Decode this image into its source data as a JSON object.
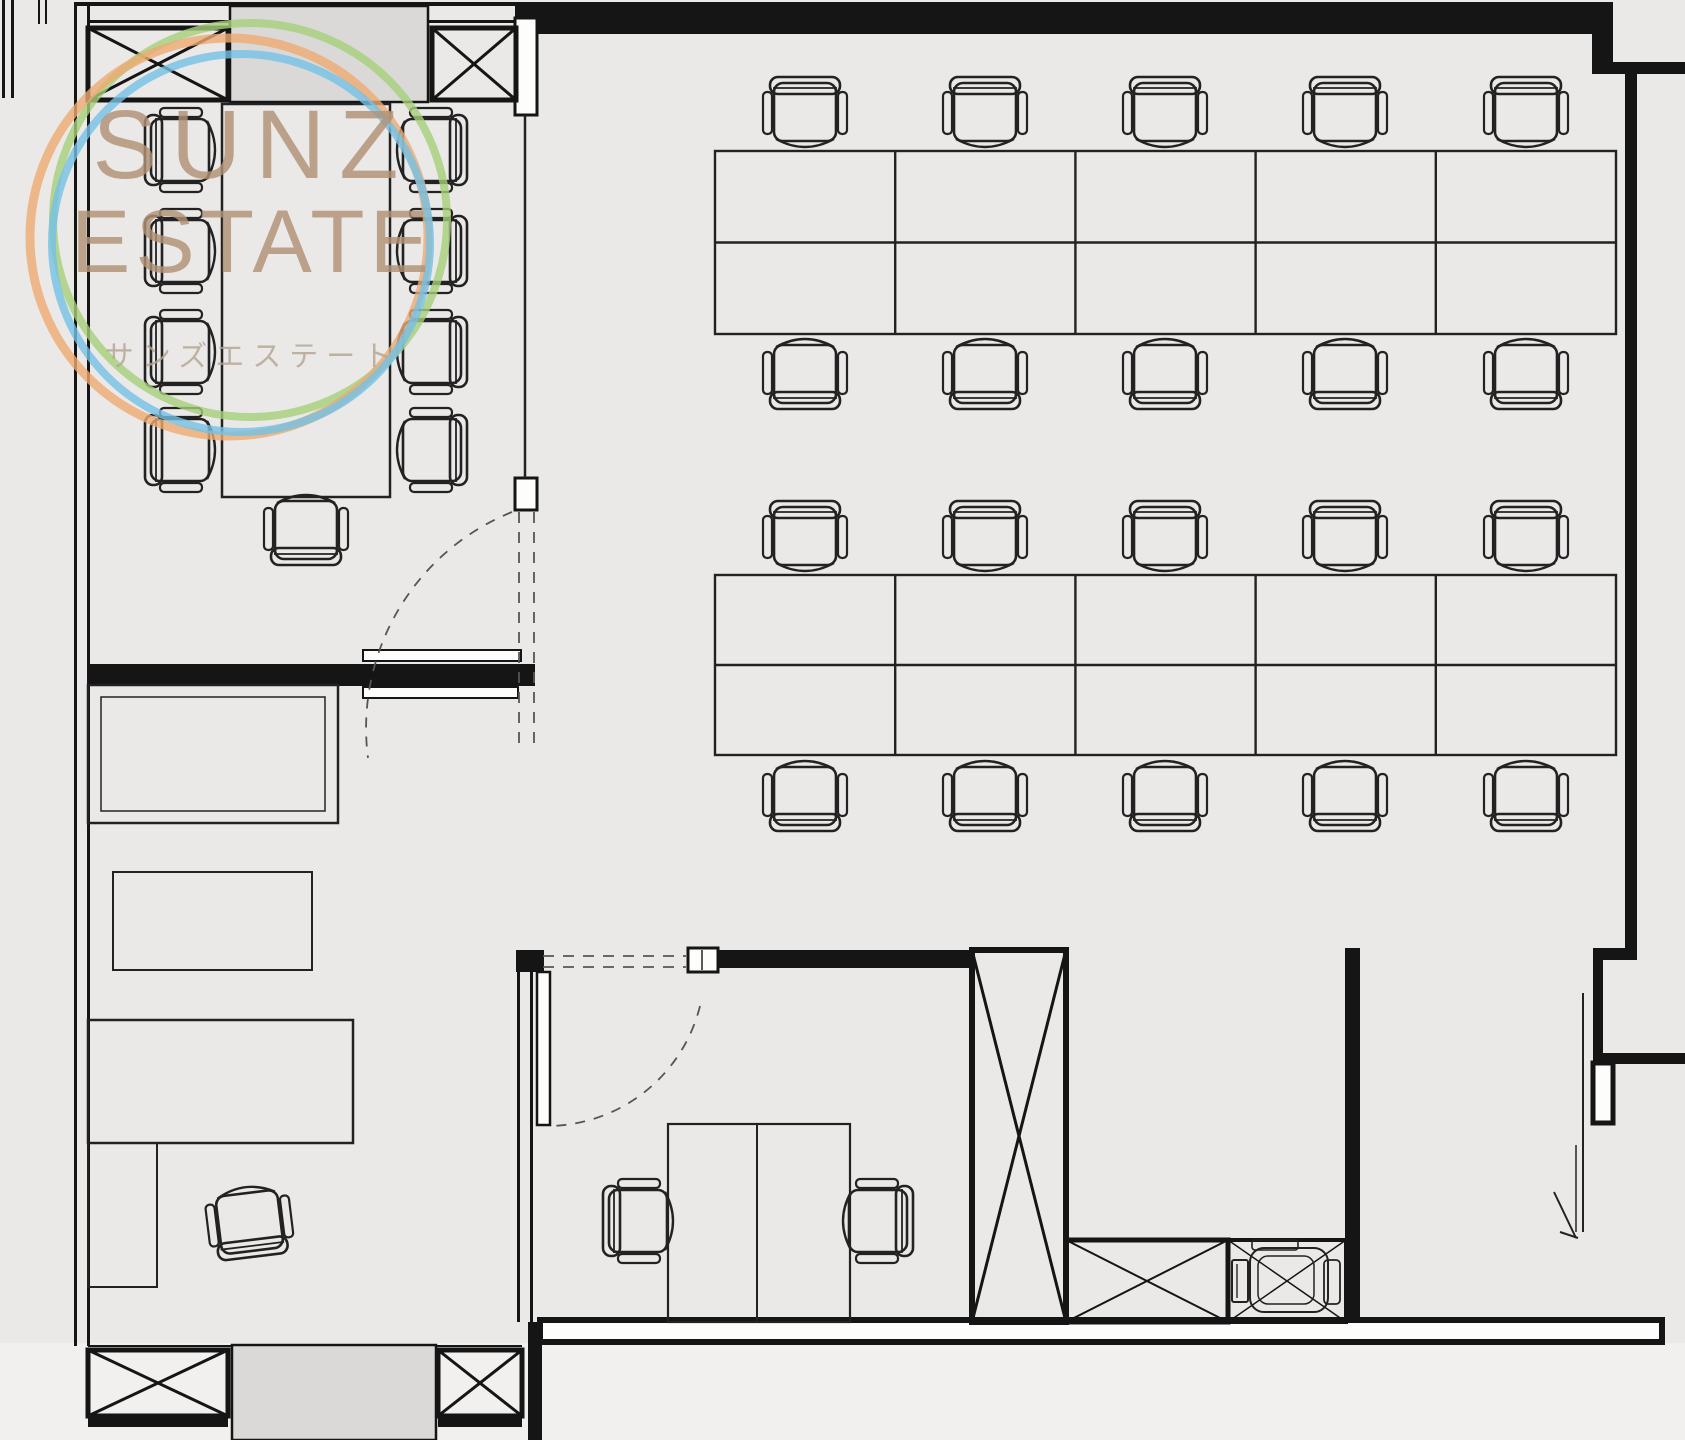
{
  "watermark": {
    "line1": "SUNZ",
    "line2": "ESTATE",
    "line3": "サンズエステート",
    "ring_green": "#a5cf7a",
    "ring_orange": "#edaa72",
    "ring_blue": "#74c0e6",
    "text_color": "#b29276"
  },
  "palette": {
    "floor": "#eae9e7",
    "outside": "#f1f0ee",
    "wall": "#151515",
    "furniture_line": "#222222",
    "panel_gray": "#dad9d7",
    "dash": "#555555"
  },
  "plan": {
    "fills": [
      {
        "r": [
          0,
          1343,
          1685,
          97
        ],
        "color": "#f1f0ee"
      }
    ],
    "walls": [
      [
        75,
        2,
        1518,
        4
      ],
      [
        74,
        2,
        3,
        1344
      ],
      [
        87,
        2,
        3,
        1344
      ],
      [
        88,
        20,
        430,
        3
      ],
      [
        515,
        6,
        1078,
        28
      ],
      [
        1592,
        2,
        21,
        72
      ],
      [
        1613,
        62,
        72,
        12
      ],
      [
        1625,
        72,
        12,
        878
      ],
      [
        1593,
        948,
        44,
        12
      ],
      [
        1593,
        958,
        10,
        98
      ],
      [
        1593,
        1053,
        92,
        11
      ],
      [
        88,
        664,
        447,
        22
      ],
      [
        515,
        103,
        22,
        12
      ],
      [
        516,
        950,
        28,
        22
      ],
      [
        716,
        950,
        258,
        18
      ],
      [
        1345,
        948,
        15,
        374
      ],
      [
        528,
        1322,
        14,
        118
      ],
      [
        517,
        952,
        3,
        370
      ],
      [
        530,
        952,
        3,
        370
      ],
      [
        2,
        0,
        3,
        98
      ],
      [
        11,
        0,
        3,
        98
      ],
      [
        38,
        0,
        2,
        24
      ],
      [
        45,
        0,
        2,
        24
      ],
      [
        88,
        1345,
        434,
        2
      ],
      [
        88,
        1416,
        140,
        11
      ],
      [
        438,
        1416,
        84,
        11
      ]
    ],
    "hollow": [
      {
        "r": [
          515,
          18,
          22,
          97
        ],
        "sw": 3
      },
      {
        "r": [
          515,
          478,
          22,
          32
        ],
        "sw": 3
      },
      {
        "r": [
          688,
          948,
          30,
          24
        ],
        "sw": 3
      },
      {
        "r": [
          1593,
          1063,
          20,
          60
        ],
        "sw": 5
      },
      {
        "r": [
          540,
          1320,
          1122,
          22
        ],
        "sw": 6
      },
      {
        "r": [
          537,
          972,
          13,
          153
        ],
        "sw": 2.5
      },
      {
        "r": [
          363,
          650,
          158,
          11
        ],
        "sw": 2
      },
      {
        "r": [
          363,
          687,
          155,
          11
        ],
        "sw": 2
      }
    ],
    "panels": [
      {
        "r": [
          230,
          6,
          198,
          96
        ]
      },
      {
        "r": [
          232,
          1345,
          204,
          95
        ]
      }
    ],
    "xboxes": [
      {
        "r": [
          88,
          28,
          140,
          72
        ],
        "sw": 5,
        "xw": 3
      },
      {
        "r": [
          432,
          28,
          84,
          72
        ],
        "sw": 5,
        "xw": 3
      },
      {
        "r": [
          88,
          1350,
          140,
          66
        ],
        "sw": 5,
        "xw": 3
      },
      {
        "r": [
          438,
          1350,
          84,
          66
        ],
        "sw": 5,
        "xw": 3
      },
      {
        "r": [
          972,
          950,
          94,
          372
        ],
        "sw": 6,
        "xw": 3
      },
      {
        "r": [
          1066,
          1240,
          162,
          82
        ],
        "sw": 5,
        "xw": 2
      },
      {
        "r": [
          1228,
          1240,
          118,
          82
        ],
        "sw": 4,
        "xw": 1.5
      }
    ],
    "furniture": [
      {
        "r": [
          222,
          104,
          168,
          393
        ],
        "sw": 2.5
      },
      {
        "r": [
          88,
          685,
          250,
          138
        ],
        "sw": 2.5
      },
      {
        "r": [
          101,
          697,
          224,
          114
        ],
        "sw": 1.5
      },
      {
        "r": [
          113,
          872,
          199,
          98
        ],
        "sw": 2
      },
      {
        "r": [
          88,
          1020,
          265,
          123
        ],
        "sw": 2.5
      },
      {
        "r": [
          88,
          1143,
          69,
          144
        ],
        "sw": 2
      },
      {
        "r": [
          668,
          1124,
          182,
          198
        ],
        "sw": 2.2
      }
    ],
    "desk_blocks": [
      {
        "r": [
          715,
          151,
          901,
          183
        ],
        "cols": 5,
        "rows": 2,
        "sw": 2.4
      },
      {
        "r": [
          715,
          575,
          901,
          180
        ],
        "cols": 5,
        "rows": 2,
        "sw": 2.4
      }
    ],
    "lines": [
      [
        525,
        115,
        525,
        478,
        2.5
      ],
      [
        702,
        950,
        702,
        970,
        1.5
      ],
      [
        757,
        1124,
        757,
        1322,
        2
      ],
      [
        1583,
        993,
        1583,
        1232,
        2
      ],
      [
        1576,
        1145,
        1576,
        1232,
        1.5
      ],
      [
        1554,
        1192,
        1576,
        1238,
        2
      ],
      [
        1560,
        1232,
        1578,
        1238,
        2
      ]
    ],
    "dashed": [
      [
        519,
        512,
        519,
        748
      ],
      [
        534,
        512,
        534,
        748
      ],
      [
        543,
        956,
        686,
        956
      ],
      [
        543,
        967,
        686,
        967
      ]
    ],
    "arcs": [
      "M 512 512 A 233 233 0 0 0 368 758",
      "M 700 1006 A 158 158 0 0 1 550 1126"
    ],
    "chairs": [
      [
        805,
        116,
        "up",
        0
      ],
      [
        985,
        116,
        "up",
        0
      ],
      [
        1165,
        116,
        "up",
        0
      ],
      [
        1345,
        116,
        "up",
        0
      ],
      [
        1526,
        116,
        "up",
        0
      ],
      [
        805,
        370,
        "down",
        0
      ],
      [
        985,
        370,
        "down",
        0
      ],
      [
        1165,
        370,
        "down",
        0
      ],
      [
        1345,
        370,
        "down",
        0
      ],
      [
        1526,
        370,
        "down",
        0
      ],
      [
        805,
        540,
        "up",
        0
      ],
      [
        985,
        540,
        "up",
        0
      ],
      [
        1165,
        540,
        "up",
        0
      ],
      [
        1345,
        540,
        "up",
        0
      ],
      [
        1526,
        540,
        "up",
        0
      ],
      [
        805,
        792,
        "down",
        0
      ],
      [
        985,
        792,
        "down",
        0
      ],
      [
        1165,
        792,
        "down",
        0
      ],
      [
        1345,
        792,
        "down",
        0
      ],
      [
        1526,
        792,
        "down",
        0
      ],
      [
        184,
        150,
        "left",
        0
      ],
      [
        184,
        251,
        "left",
        0
      ],
      [
        184,
        352,
        "left",
        0
      ],
      [
        184,
        450,
        "left",
        0
      ],
      [
        428,
        150,
        "right",
        0
      ],
      [
        428,
        251,
        "right",
        0
      ],
      [
        428,
        352,
        "right",
        0
      ],
      [
        428,
        450,
        "right",
        0
      ],
      [
        306,
        526,
        "down",
        0
      ],
      [
        642,
        1221,
        "left",
        0
      ],
      [
        874,
        1221,
        "right",
        0
      ],
      [
        249,
        1218,
        "down",
        -7
      ]
    ],
    "toilet": {
      "tank": [
        1232,
        1260,
        16,
        42
      ],
      "bowl": [
        1250,
        1248,
        78,
        64
      ],
      "bowl_inner": [
        1258,
        1256,
        56,
        48
      ],
      "cistern": [
        1252,
        1240,
        46,
        10
      ],
      "seat": [
        1324,
        1260,
        16,
        44
      ]
    },
    "rings": [
      {
        "cx": 250,
        "cy": 220,
        "rr": 197,
        "key": "ring_green",
        "sw": 8
      },
      {
        "cx": 229,
        "cy": 237,
        "rr": 199,
        "key": "ring_orange",
        "sw": 9
      },
      {
        "cx": 241,
        "cy": 243,
        "rr": 189,
        "key": "ring_blue",
        "sw": 8
      }
    ]
  }
}
